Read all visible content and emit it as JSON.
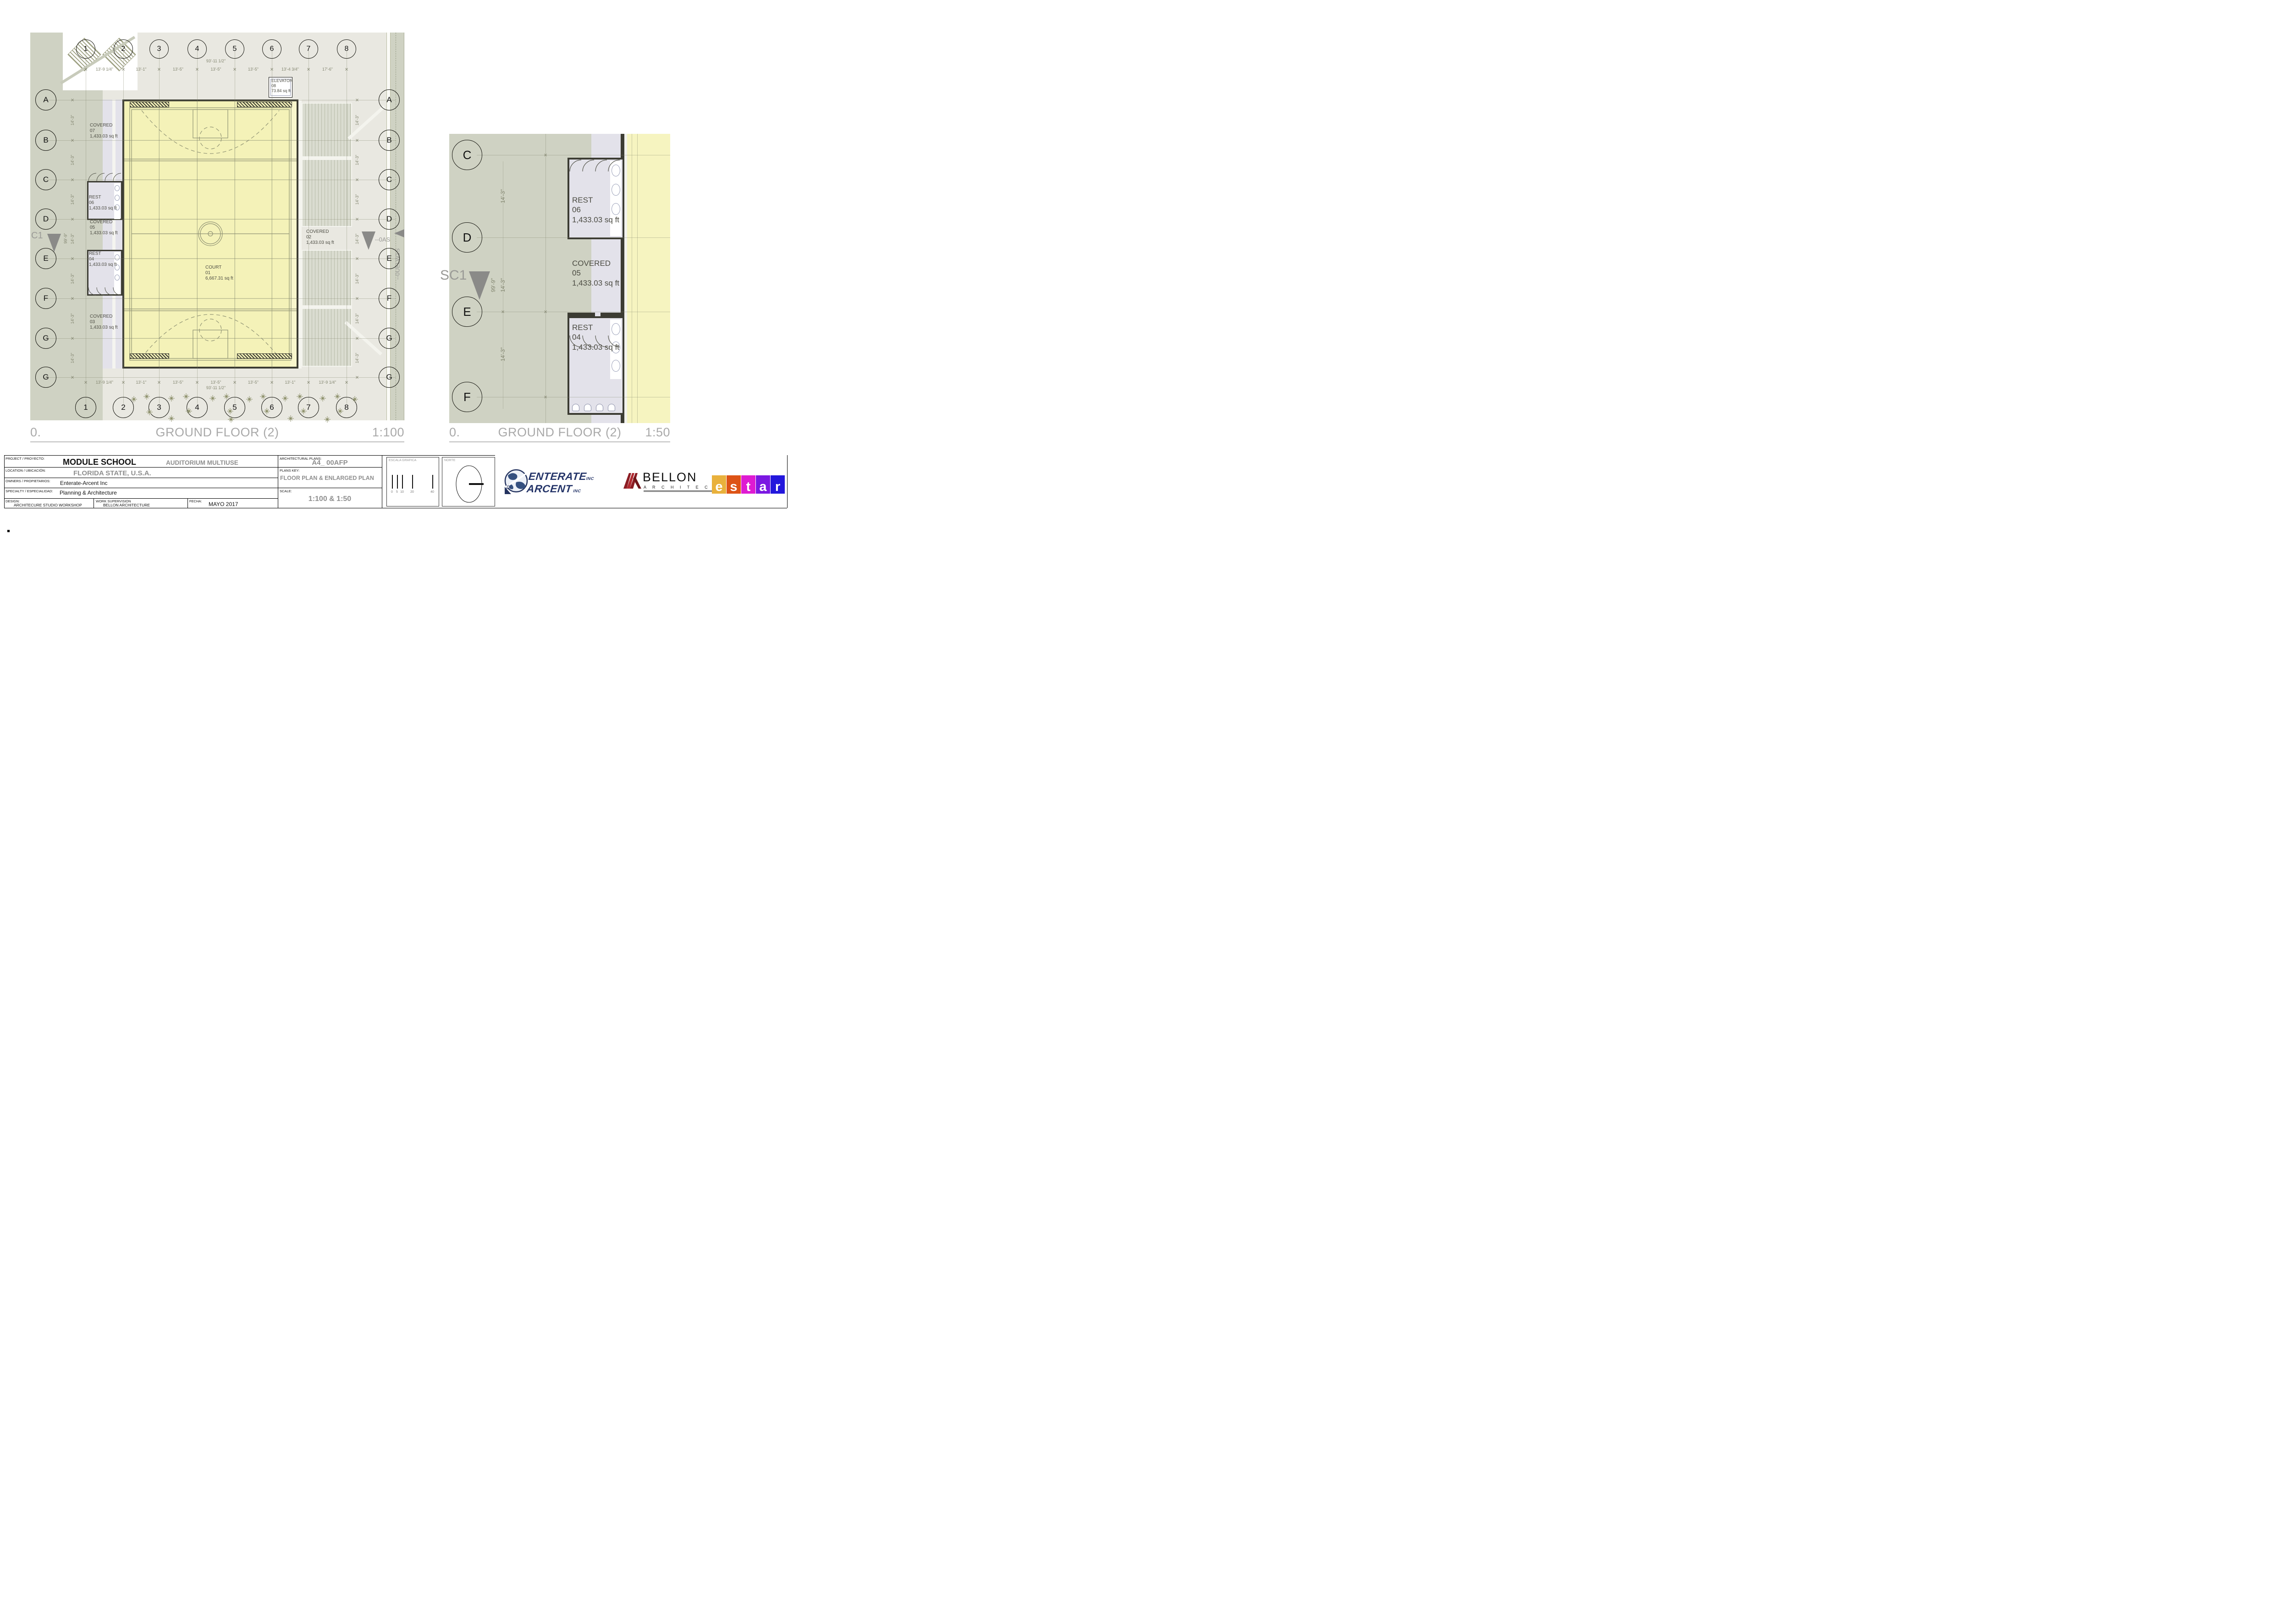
{
  "main_plan": {
    "caption": {
      "number": "0.",
      "title": "GROUND FLOOR (2)",
      "scale": "1:100"
    },
    "grid": {
      "cols": [
        "1",
        "2",
        "3",
        "4",
        "5",
        "6",
        "7",
        "8"
      ],
      "rows": [
        "A",
        "B",
        "C",
        "D",
        "E",
        "F",
        "G",
        "G"
      ]
    },
    "dims": {
      "overall_top": "93'-11 1/2\"",
      "overall_bottom": "93'-11 1/2\"",
      "overall_left": "99'-9\"",
      "top": [
        "13'-9 1/4\"",
        "13'-1\"",
        "13'-5\"",
        "13'-5\"",
        "13'-5\"",
        "13'-4 3/4\"",
        "17'-6\""
      ],
      "bottom": [
        "13'-9 1/4\"",
        "13'-1\"",
        "13'-5\"",
        "13'-5\"",
        "13'-5\"",
        "13'-1\"",
        "13'-9 1/4\""
      ],
      "bay": "14'-3\""
    },
    "rooms": {
      "court": {
        "name": "COURT",
        "number": "01",
        "area": "6,667.31 sq ft"
      },
      "covered07": {
        "name": "COVERED",
        "number": "07",
        "area": "1,433.03 sq ft"
      },
      "rest06": {
        "name": "REST",
        "number": "06",
        "area": "1,433.03 sq ft"
      },
      "covered05": {
        "name": "COVERED",
        "number": "05",
        "area": "1,433.03 sq ft"
      },
      "rest04": {
        "name": "REST",
        "number": "04",
        "area": "1,433.03 sq ft"
      },
      "covered03": {
        "name": "COVERED",
        "number": "03",
        "area": "1,433.03 sq ft"
      },
      "covered02": {
        "name": "COVERED",
        "number": "02",
        "area": "1,433.03 sq ft"
      },
      "elevator": {
        "name": "ELEVATOR",
        "number": "08",
        "area": "73.84 sq ft"
      }
    },
    "markers": {
      "c1": "C1",
      "road_h": "--0AS",
      "road_v": "--0UELW1S"
    }
  },
  "enlarged_plan": {
    "caption": {
      "number": "0.",
      "title": "GROUND FLOOR (2)",
      "scale": "1:50"
    },
    "grid": {
      "rows": [
        "C",
        "D",
        "E",
        "F"
      ]
    },
    "dims": {
      "bay_top": "14'-3\"",
      "overall": "99'-9\"",
      "bay_mid": "14'-3\"",
      "bay_bottom": "14'-3\""
    },
    "rooms": {
      "rest06": {
        "name": "REST",
        "number": "06",
        "area": "1,433.03 sq ft"
      },
      "covered05": {
        "name": "COVERED",
        "number": "05",
        "area": "1,433.03 sq ft"
      },
      "rest04": {
        "name": "REST",
        "number": "04",
        "area": "1,433.03 sq ft"
      }
    },
    "markers": {
      "sc1": "SC1"
    }
  },
  "title_block": {
    "project_label": "PROJECT / PROYECTO:",
    "project": "MODULE SCHOOL",
    "project2": "AUDITORIUM MULTIUSE",
    "location_label": "LOCATION / UBICACIÓN:",
    "location": "FLORIDA STATE, U.S.A.",
    "owners_label": "OWNERS / PROPIETARIOS:",
    "owners": "Enterate-Arcent Inc",
    "specialty_label": "SPECIALTY / ESPECIALIDAD:",
    "specialty": "Planning & Architecture",
    "design_label": "DESIGN:",
    "design": "ARCHITECURE STUDIO WORKSHOP",
    "supervision_label": "WORK SUPERVISION",
    "supervision": "BELLON ARCHITECTURE",
    "date_label": "FECHA:",
    "date": "MAYO  2017",
    "plans_label": "ARCHITECTURAL PLANS:",
    "plans_code": "A4_ 00AFP",
    "plans_key_label": "PLANS KEY:",
    "plans_key": "FLOOR PLAN & ENLARGED PLAN",
    "scale_label": "SCALE:",
    "scale": "1:100 & 1:50",
    "escala_label": "ESCALA  GRAFICA",
    "escala_ticks": [
      "0",
      "5",
      "10",
      "20",
      "40"
    ],
    "norte_label": "NORTE"
  },
  "logos": {
    "enterate": {
      "line1": "ENTERATE",
      "suffix1": "INC",
      "line2": "ARCENT",
      "suffix2": "INC"
    },
    "bellon": {
      "name": "BELLON",
      "sub": "A R C H I T E C T U R E"
    },
    "estar": {
      "letters": [
        "e",
        "s",
        "t",
        "a",
        "r"
      ],
      "colors": [
        "#e9b13c",
        "#dd5316",
        "#de1bd2",
        "#7b18e2",
        "#2317dc"
      ]
    }
  },
  "colors": {
    "accent_navy": "#253569",
    "bellon_red": "#a02028",
    "court_yellow": "#f4f2b8",
    "olive": "#cfd2c3",
    "lavender": "#e3e2ea",
    "wall": "#3c3c33",
    "caption_grey": "#a9a9a9"
  }
}
